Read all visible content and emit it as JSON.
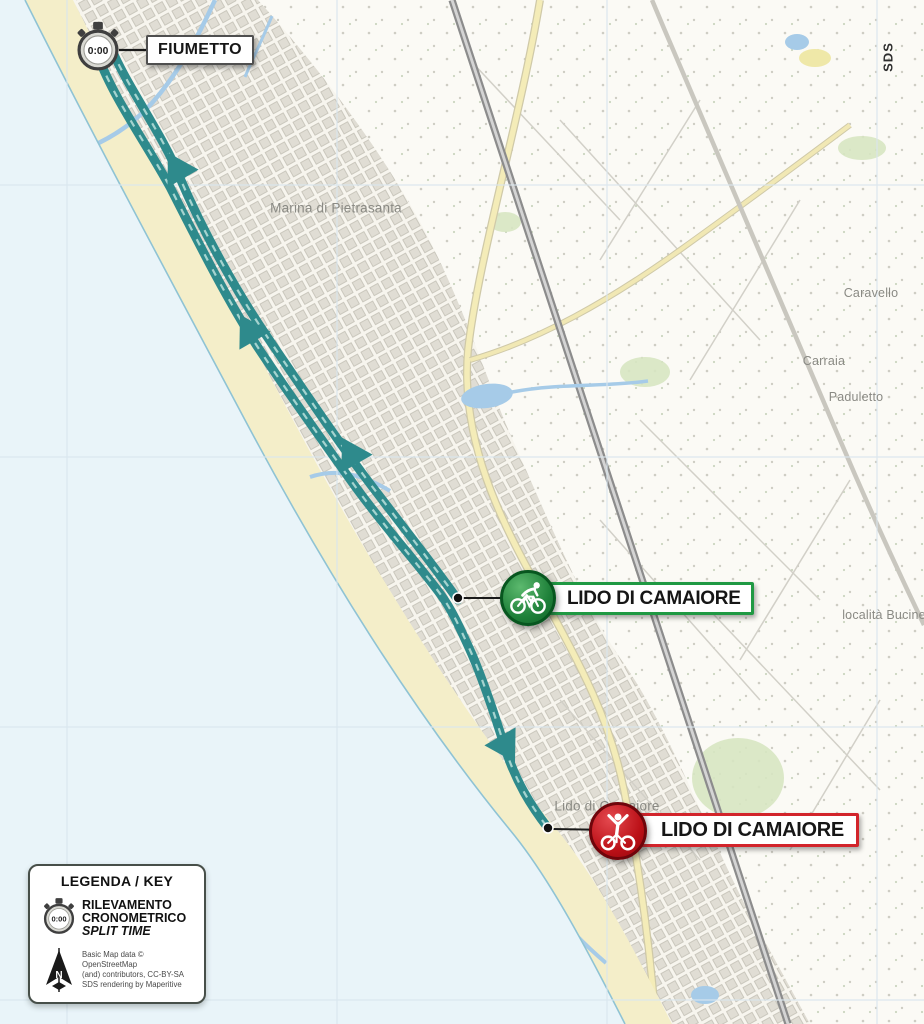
{
  "map": {
    "watermark": "SDS",
    "stopwatch_time": "0:00",
    "place_labels": [
      {
        "id": "marina",
        "text": "Marina di Pietrasanta"
      },
      {
        "id": "caravello",
        "text": "Caravello"
      },
      {
        "id": "carraia",
        "text": "Carraia"
      },
      {
        "id": "paduletto",
        "text": "Paduletto"
      },
      {
        "id": "bucine",
        "text": "località Bucine"
      },
      {
        "id": "lido",
        "text": "Lido di Camaiore"
      }
    ],
    "markers": {
      "split": {
        "label": "FIUMETTO"
      },
      "start": {
        "label": "LIDO DI CAMAIORE"
      },
      "finish": {
        "label": "LIDO DI CAMAIORE"
      }
    },
    "colors": {
      "route_teal": "#2e8a8c",
      "route_dash": "#a5d3cf",
      "start_green": "#1f9943",
      "finish_red": "#d2242b",
      "sea": "#e9f4f9",
      "beach": "#f4eec9"
    }
  },
  "legend": {
    "title": "LEGENDA / KEY",
    "north_letter": "N",
    "split": {
      "line1": "RILEVAMENTO",
      "line2": "CRONOMETRICO",
      "line3": "SPLIT TIME"
    },
    "attribution": {
      "line1": "Basic Map data © OpenStreetMap",
      "line2": "(and) contributors, CC-BY-SA",
      "line3": "SDS rendering by Maperitive"
    }
  }
}
